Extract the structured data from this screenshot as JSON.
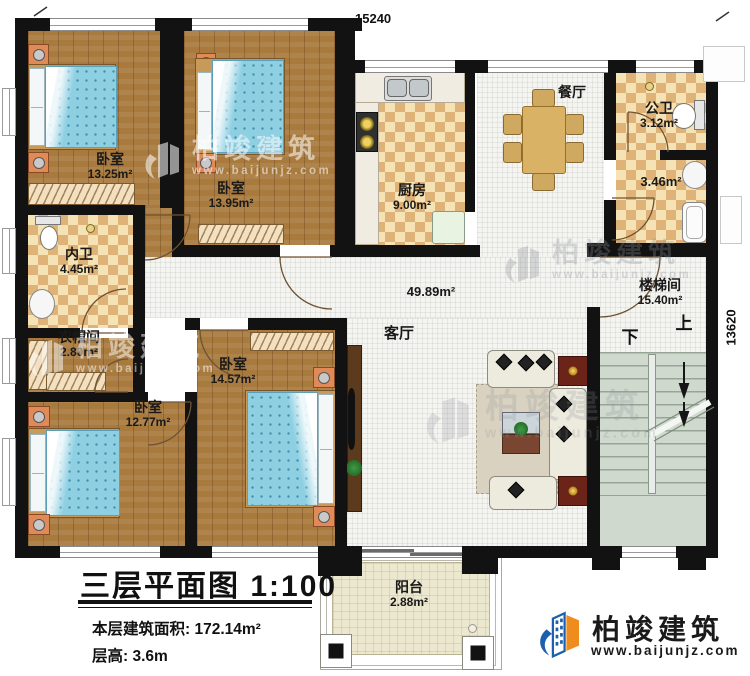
{
  "dimensions": {
    "top": "15240",
    "right": "13620"
  },
  "rooms": {
    "bedroom_tl": {
      "name": "卧室",
      "area": "13.25m²"
    },
    "bedroom_tm": {
      "name": "卧室",
      "area": "13.95m²"
    },
    "bedroom_bl": {
      "name": "卧室",
      "area": "12.77m²"
    },
    "bedroom_bm": {
      "name": "卧室",
      "area": "14.57m²"
    },
    "kitchen": {
      "name": "厨房",
      "area": "9.00m²"
    },
    "dining": {
      "name": "餐厅"
    },
    "public_bath": {
      "name": "公卫",
      "area": "3.12m²"
    },
    "bath_lower": {
      "area": "3.46m²"
    },
    "ensuite_bath": {
      "name": "内卫",
      "area": "4.45m²"
    },
    "cloakroom": {
      "name": "衣帽间",
      "area": "2.80m²"
    },
    "living": {
      "name": "客厅",
      "area": "49.89m²"
    },
    "stairwell": {
      "name": "楼梯间",
      "area": "15.40m²",
      "up": "上",
      "down": "下"
    },
    "balcony": {
      "name": "阳台",
      "area": "2.88m²"
    }
  },
  "title_block": {
    "title": "三层平面图 1:100",
    "area_label": "本层建筑面积:",
    "area_value": "172.14m²",
    "height_label": "层高:",
    "height_value": "3.6m"
  },
  "branding": {
    "name": "柏竣建筑",
    "website": "www.baijunjz.com"
  },
  "colors": {
    "wall": "#121212",
    "wood_floor": "#a87a3e",
    "checker_light": "#f6e3b5",
    "checker_dark": "#dfb277",
    "tile": "#f4f4f1",
    "stairs": "#cfd9cd",
    "balcony": "#ece7cf",
    "bed": "#8ecfe2",
    "logo_blue": "#1b5fad",
    "logo_orange": "#f08c1e"
  }
}
